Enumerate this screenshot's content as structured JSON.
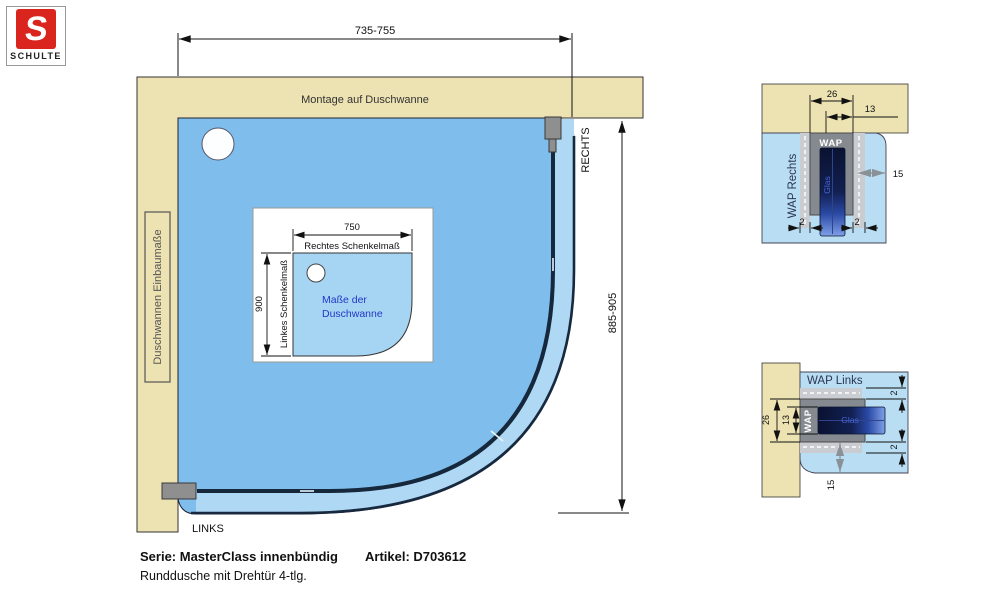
{
  "logo": {
    "letter": "S",
    "brand": "SCHULTE"
  },
  "colors": {
    "wall_tan": "#EDE2B2",
    "shower_blue": "#7FBEEC",
    "band_blue": "#AFD8F4",
    "detail_blue": "#B9DEF3",
    "inset_blue": "#A5D5F3",
    "glass_dark": "#16283C",
    "profile_gray": "#858A90",
    "logo_red": "#D9251D"
  },
  "main_drawing": {
    "dim_width": "735-755",
    "dim_height": "885-905",
    "wall_top_label": "Montage auf Duschwanne",
    "wall_left_label": "Duschwannen Einbaumaße",
    "corner_right_label": "RECHTS",
    "corner_left_label": "LINKS",
    "inset": {
      "dim_width": "750",
      "dim_height": "900",
      "top_label": "Rechtes Schenkelmaß",
      "left_label": "Linkes Schenkelmaß",
      "center_line1": "Maße der",
      "center_line2": "Duschwanne"
    }
  },
  "detail_right": {
    "title": "WAP Rechts",
    "profile_label": "WAP",
    "glass_label": "Glas",
    "dims": {
      "width": "26",
      "half": "13",
      "depth": "15",
      "gap_left": "2",
      "gap_right": "2"
    }
  },
  "detail_left": {
    "title": "WAP Links",
    "profile_label": "WAP",
    "glass_label": "Glas",
    "dims": {
      "width": "26",
      "half": "13",
      "depth": "15",
      "gap_top": "2",
      "gap_bottom": "2"
    }
  },
  "footer": {
    "series_label": "Serie: MasterClass innenbündig",
    "article_label": "Artikel: D703612",
    "description": "Runddusche mit Drehtür 4-tlg."
  }
}
